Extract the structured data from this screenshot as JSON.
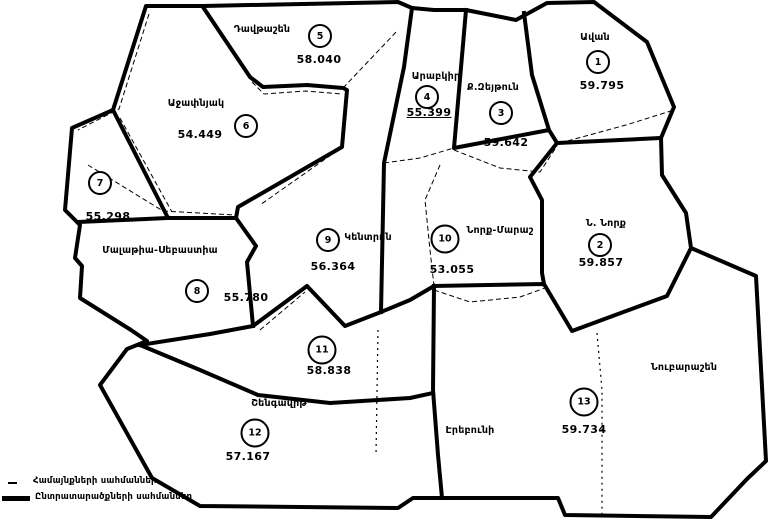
{
  "map_title": "Yerevan electoral districts map",
  "districts": [
    {
      "number": "1",
      "name": "Ավան",
      "value": "59.795"
    },
    {
      "number": "2",
      "name": "Ն. Նորք",
      "value": "59.857"
    },
    {
      "number": "3",
      "name": "Ք.Զեյթուն",
      "value": "59.642"
    },
    {
      "number": "4",
      "name": "Արաբկիր",
      "value": "55.399"
    },
    {
      "number": "5",
      "name": "Դավթաշեն",
      "value": "58.040"
    },
    {
      "number": "6",
      "name": "Աջափնյակ",
      "value": "54.449"
    },
    {
      "number": "7",
      "name": "",
      "value": "55.298"
    },
    {
      "number": "8",
      "name": "Մալաթիա-Սեբաստիա",
      "value": "55.780"
    },
    {
      "number": "9",
      "name": "Կենտրոն",
      "value": "56.364"
    },
    {
      "number": "10",
      "name": "Նորք-Մարաշ",
      "value": "53.055"
    },
    {
      "number": "11",
      "name": "Շենգավիթ",
      "value": "58.838"
    },
    {
      "number": "12",
      "name": "",
      "value": "57.167"
    },
    {
      "number": "13",
      "name": "",
      "value": "59.734"
    }
  ],
  "area_labels": [
    {
      "text": "Էրեբունի"
    },
    {
      "text": "Նուբարաշեն"
    }
  ],
  "legend": {
    "items": [
      {
        "label": "Համայնքների սահմաններ",
        "line_type": "thin"
      },
      {
        "label": "Ընտրատարածքների սահմաններ",
        "line_type": "thick"
      }
    ]
  },
  "colors": {
    "line": "#000000",
    "background": "#ffffff"
  }
}
